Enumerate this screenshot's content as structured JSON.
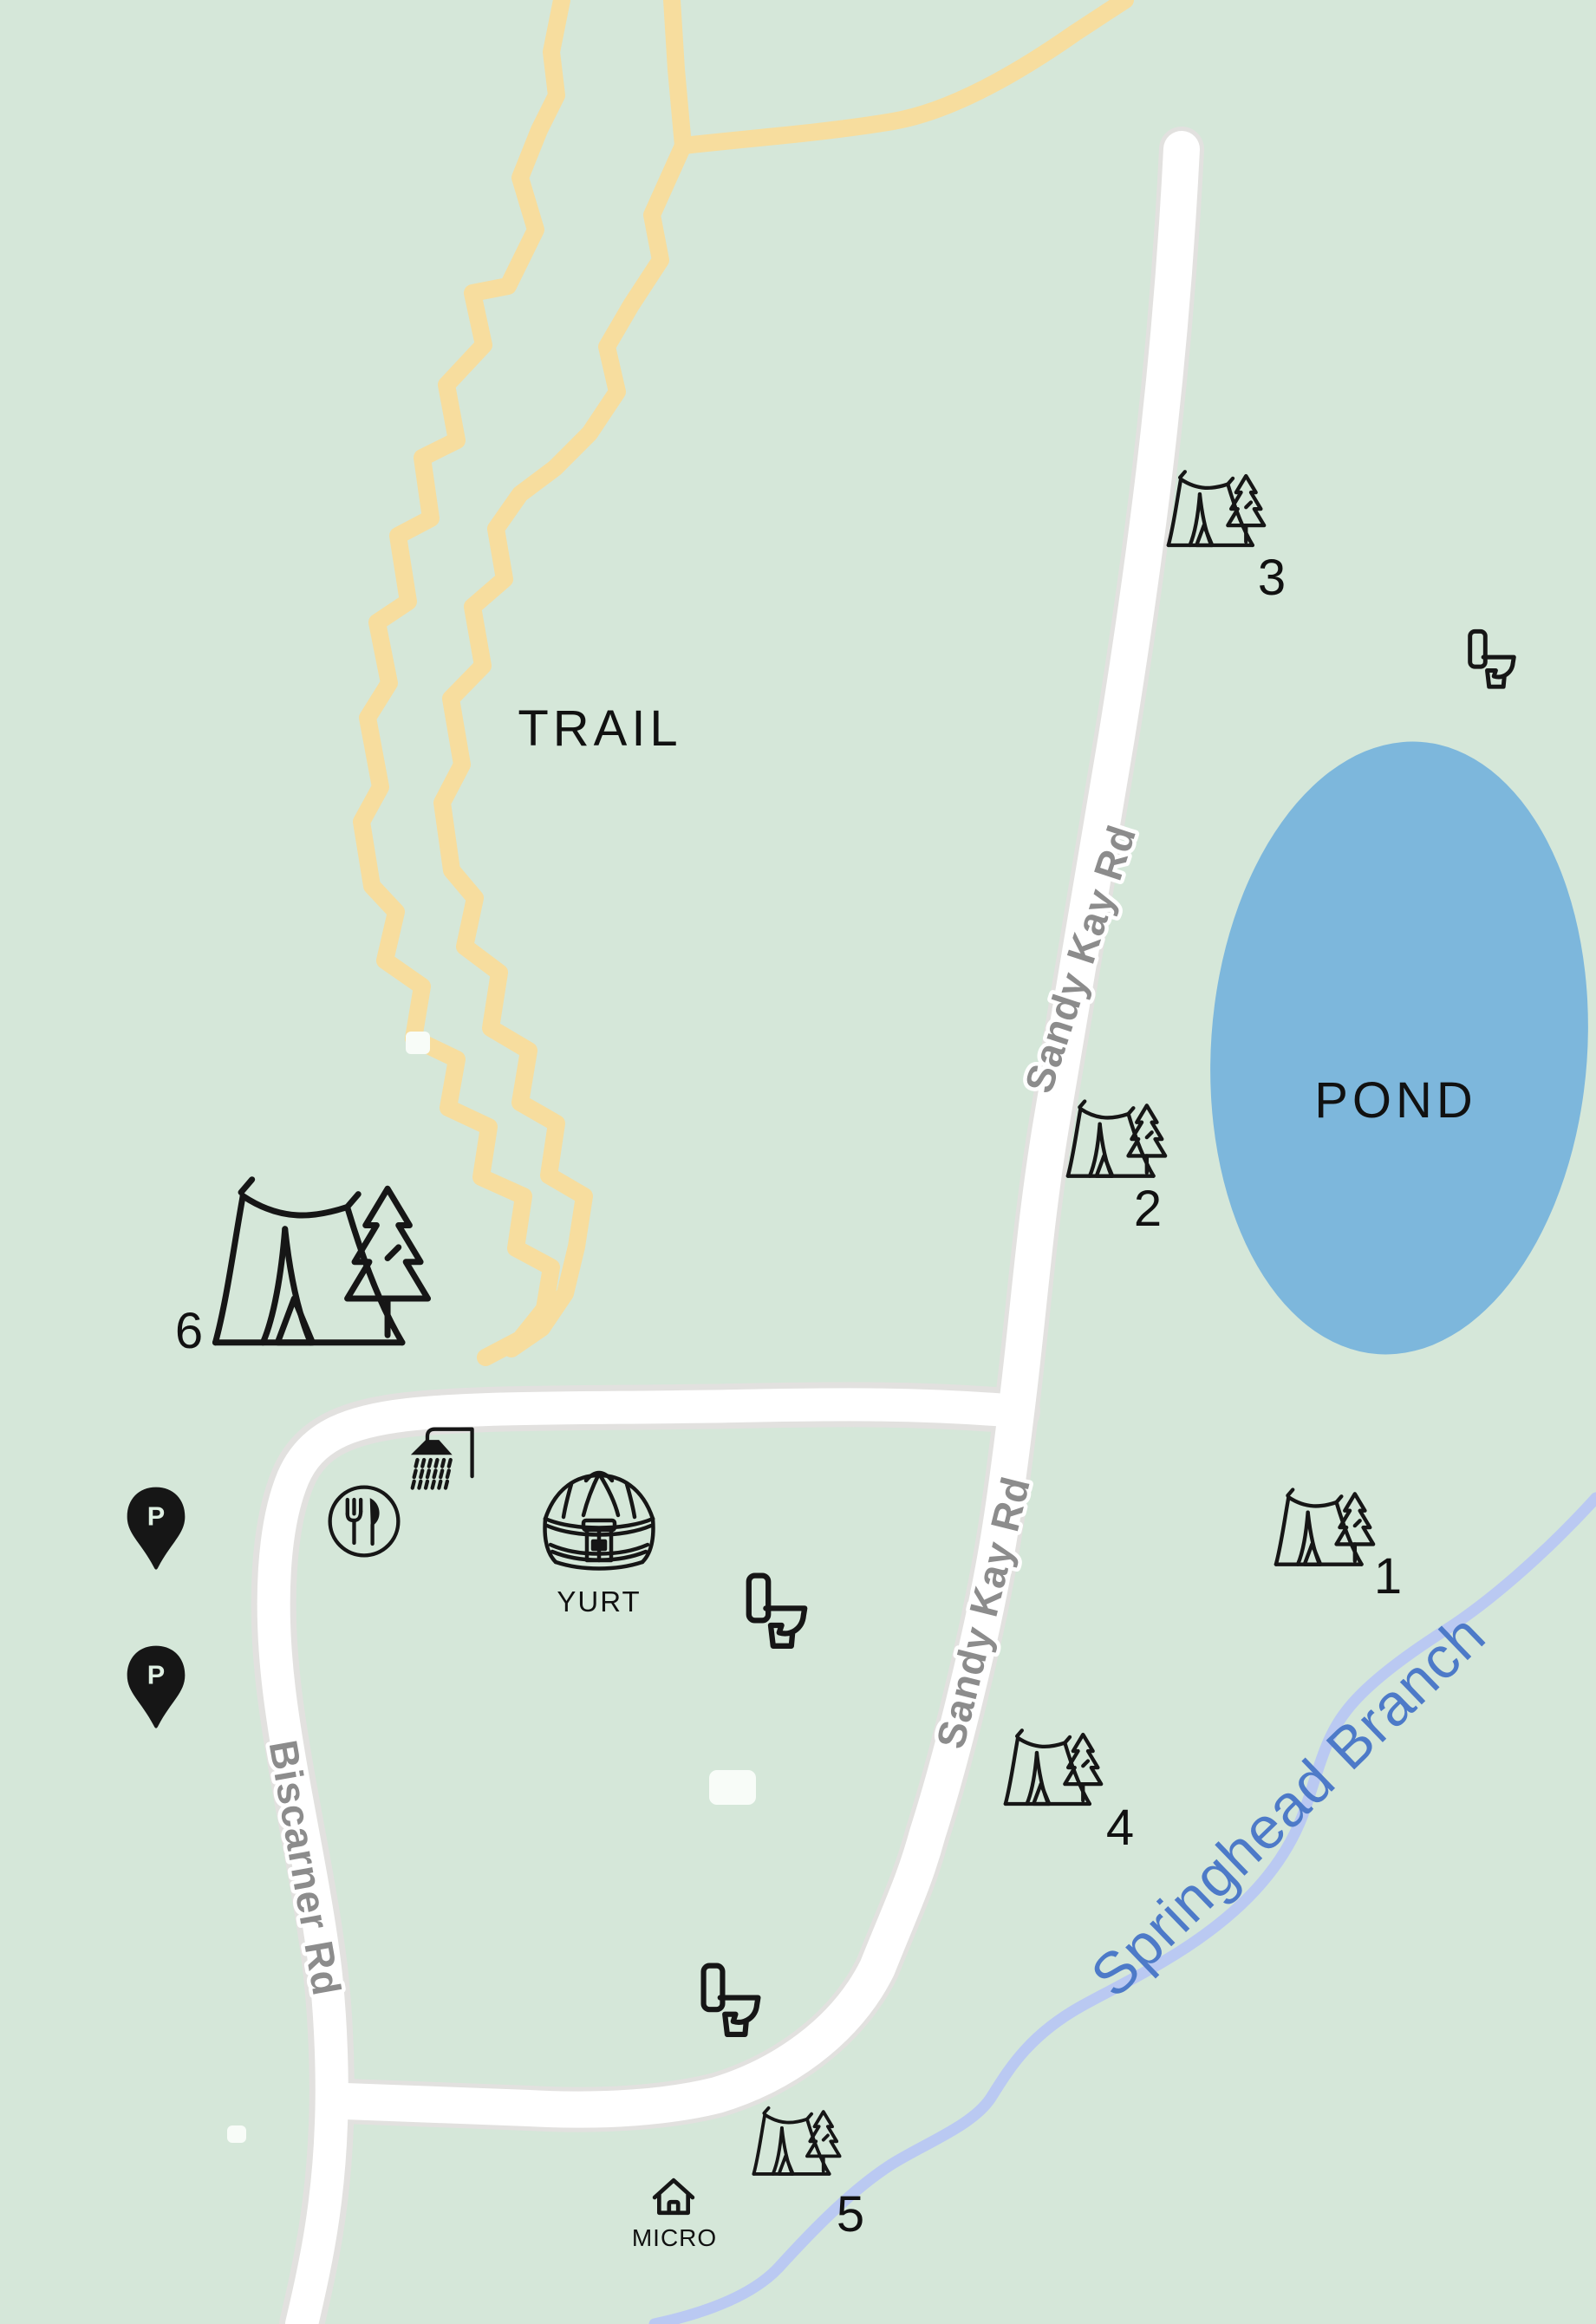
{
  "regions": {
    "trail_label": "TRAIL",
    "pond_label": "POND"
  },
  "roads": {
    "sandy_kay_upper": "Sandy Kay Rd",
    "sandy_kay_lower": "Sandy Kay Rd",
    "biscarner": "Biscarner Rd"
  },
  "water": {
    "stream_label": "Springhead Branch"
  },
  "campsites": [
    {
      "number": "1"
    },
    {
      "number": "2"
    },
    {
      "number": "3"
    },
    {
      "number": "4"
    },
    {
      "number": "5"
    },
    {
      "number": "6"
    }
  ],
  "facilities": {
    "yurt_label": "YURT",
    "micro_cabin_label": "MICRO",
    "parking_symbol": "P"
  },
  "colors": {
    "background": "#d5e7d9",
    "trail": "#f7dd9e",
    "road": "#ffffff",
    "road_casing": "#e2e1df",
    "pond": "#7db7dc",
    "stream": "#bac9f2",
    "stream_label": "#4d7ac8",
    "road_label": "#8c8c8c",
    "ink": "#161616"
  }
}
